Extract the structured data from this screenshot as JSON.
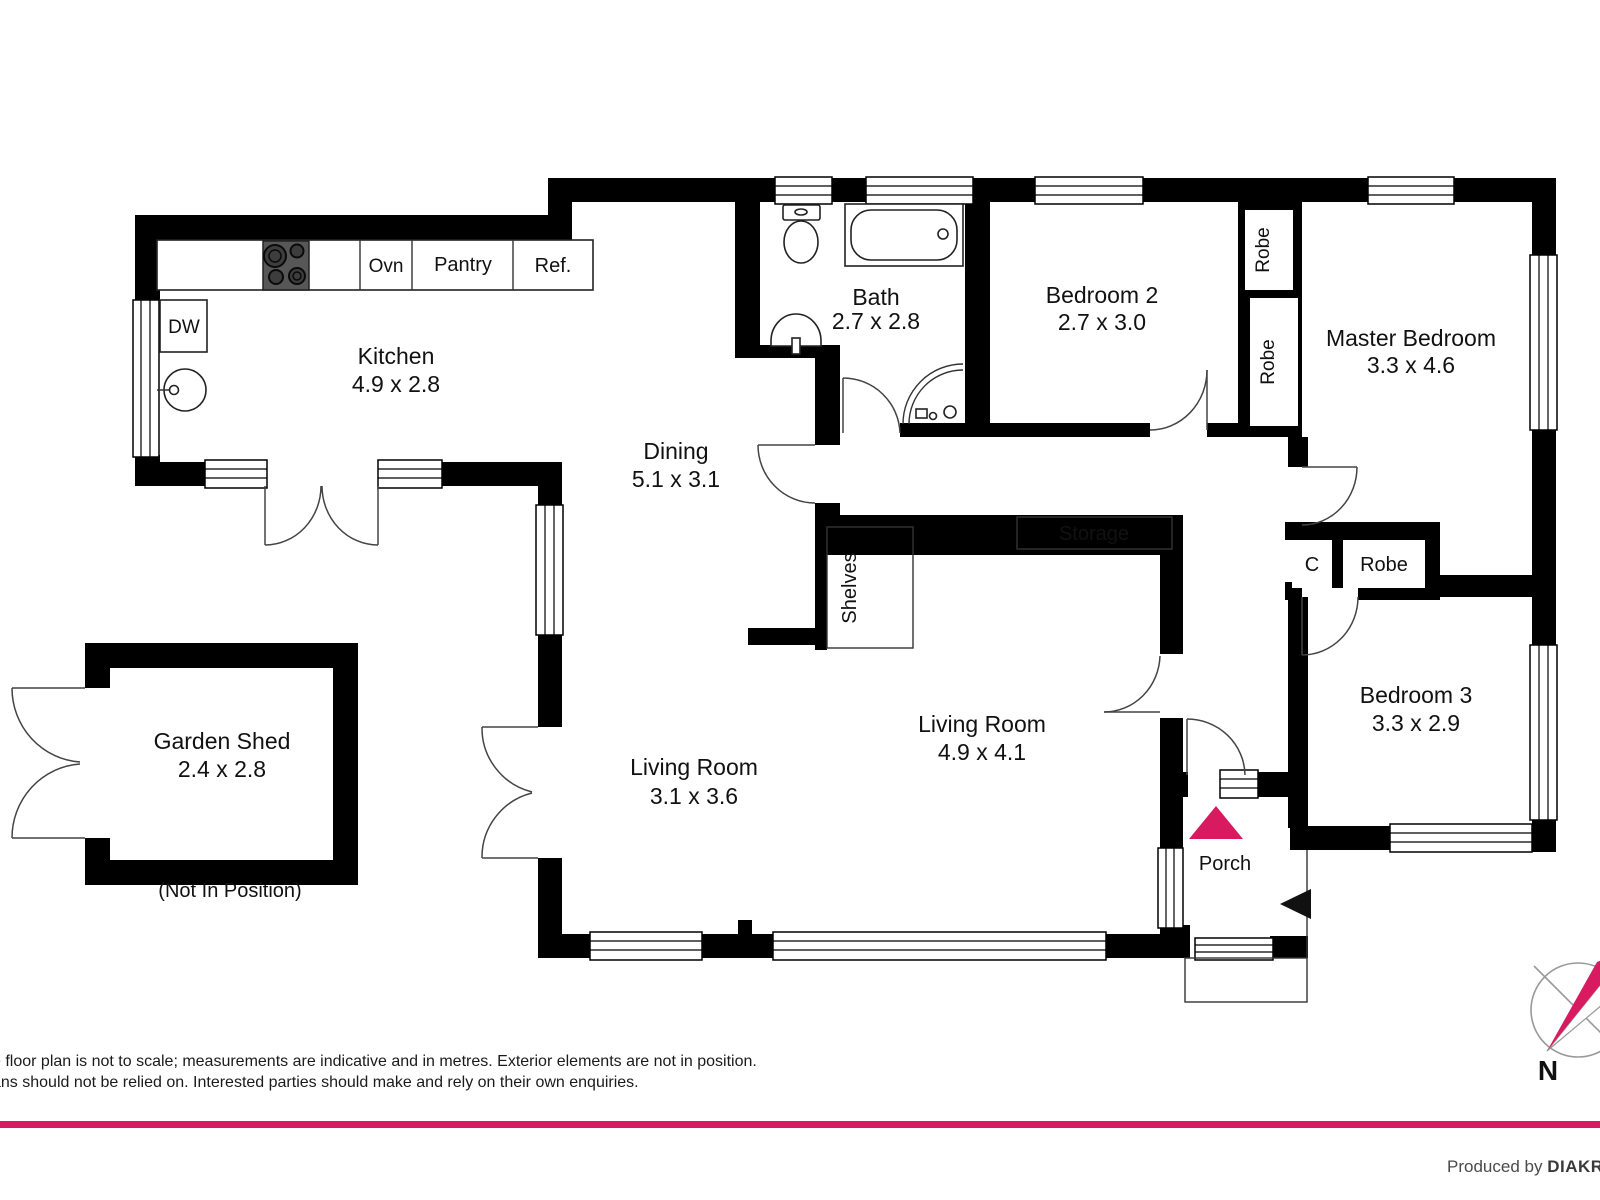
{
  "colors": {
    "accent_magenta": "#D81B60",
    "wall_black": "#000000"
  },
  "rooms": {
    "kitchen": {
      "name": "Kitchen",
      "dims": "4.9 x 2.8"
    },
    "bath": {
      "name": "Bath",
      "dims": "2.7 x 2.8"
    },
    "bedroom2": {
      "name": "Bedroom 2",
      "dims": "2.7 x 3.0"
    },
    "master": {
      "name": "Master Bedroom",
      "dims": "3.3 x 4.6"
    },
    "dining": {
      "name": "Dining",
      "dims": "5.1 x 3.1"
    },
    "living1": {
      "name": "Living Room",
      "dims": "3.1 x 3.6"
    },
    "living2": {
      "name": "Living Room",
      "dims": "4.9 x 4.1"
    },
    "bedroom3": {
      "name": "Bedroom 3",
      "dims": "3.3 x 2.9"
    },
    "porch": {
      "name": "Porch"
    },
    "shed": {
      "name": "Garden Shed",
      "dims": "2.4 x 2.8",
      "note": "(Not In Position)"
    }
  },
  "labels": {
    "dw": "DW",
    "ovn": "Ovn",
    "pantry": "Pantry",
    "ref": "Ref.",
    "robe": "Robe",
    "c": "C",
    "storage": "Storage",
    "shelves": "Shelves"
  },
  "compass": {
    "north": "N"
  },
  "footer": {
    "disclaimer_line1": "e floor plan is not to scale; measurements are indicative and in metres. Exterior elements are not in position.",
    "disclaimer_line2": "ans should not be relied on. Interested parties should make and rely on their own enquiries.",
    "produced_by": "Produced by ",
    "brand": "DIAKR"
  }
}
